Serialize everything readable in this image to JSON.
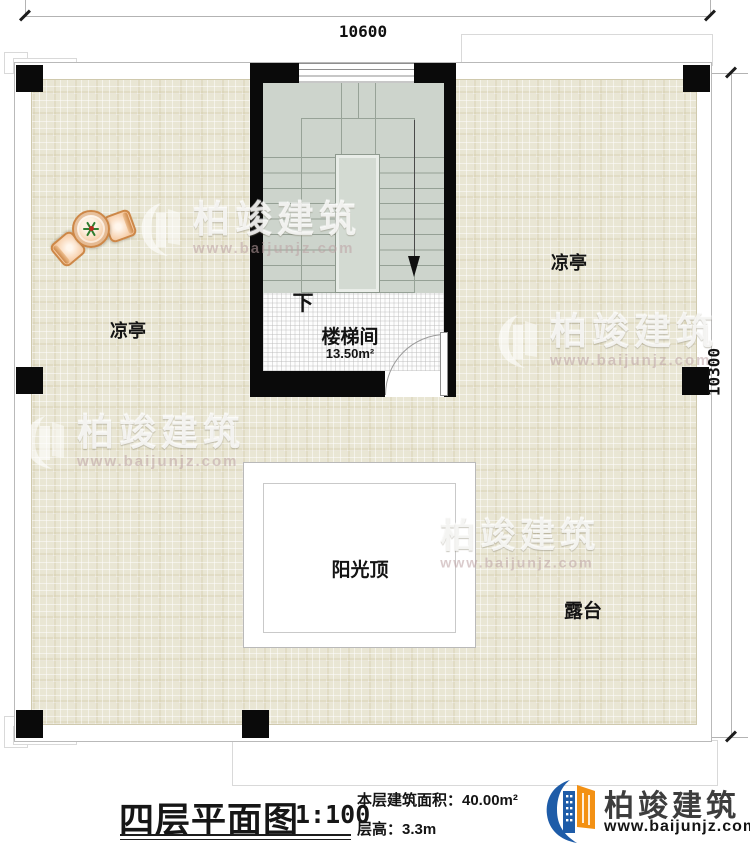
{
  "dimensions": {
    "top": "10600",
    "right": "10300"
  },
  "rooms": {
    "stairwell_label": "楼梯间",
    "stairwell_area": "13.50m²",
    "down_label": "下",
    "pavilion_left": "凉亭",
    "pavilion_right": "凉亭",
    "skylight_label": "阳光顶",
    "terrace_label": "露台"
  },
  "watermark": {
    "brand": "柏竣建筑",
    "url": "www.baijunjz.com"
  },
  "title_block": {
    "title": "四层平面图",
    "scale": "1:100",
    "area_text": "本层建筑面积：40.00m²",
    "floor_height_text": "层高：3.3m"
  },
  "company": {
    "name": "柏竣建筑",
    "url": "www.baijunjz.com"
  },
  "colors": {
    "wall": "#0a0a0a",
    "terrace_tile": "#e9e6d4",
    "stair_floor": "#cdd4cc",
    "logo_blue": "#1e5ca8",
    "logo_orange": "#f39114"
  }
}
